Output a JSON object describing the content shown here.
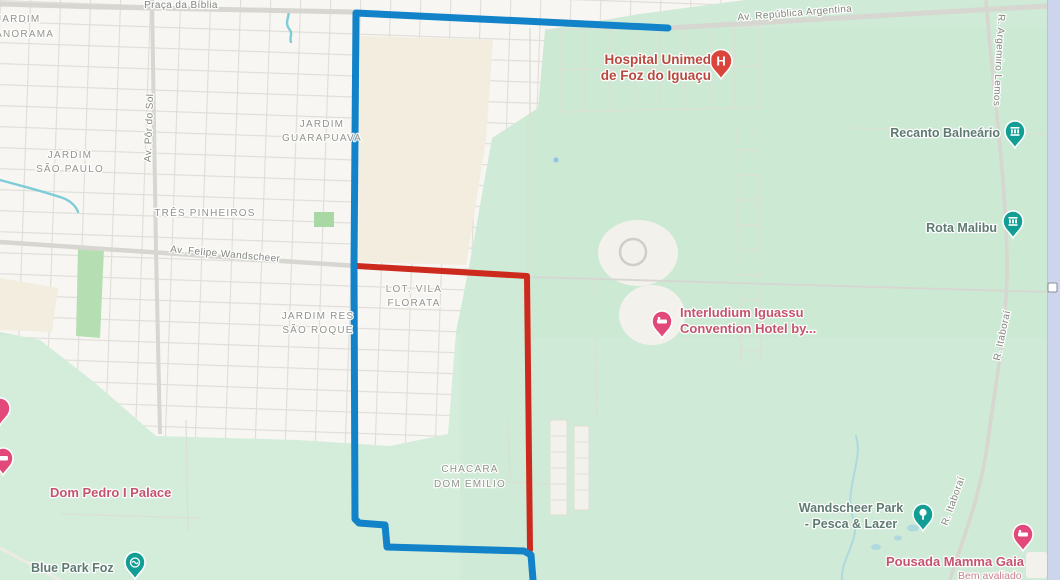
{
  "map": {
    "streets": {
      "praca_da_biblia": "Praça da Bíblia",
      "av_republica_argentina": "Av. República Argentina",
      "r_argemiro_lemos": "R. Argemiro Lemos",
      "av_por_do_sol": "Av. Pôr do Sol",
      "av_felipe_wandscheer": "Av. Felipe Wandscheer",
      "r_itaborai_upper": "R. Itaboraí",
      "r_itaborai_lower": "R. Itaboraí"
    },
    "areas": {
      "jardim_panorama_l1": "JARDIM",
      "jardim_panorama_l2": "PANORAMA",
      "jardim_guarapuava_l1": "JARDIM",
      "jardim_guarapuava_l2": "GUARAPUAVA",
      "jardim_sao_paulo_l1": "JARDIM",
      "jardim_sao_paulo_l2": "SÃO PAULO",
      "tres_pinheiros": "TRÊS PINHEIROS",
      "lot_vila_florata_l1": "LOT. VILA",
      "lot_vila_florata_l2": "FLORATA",
      "jardim_res_sao_roque_l1": "JARDIM RES",
      "jardim_res_sao_roque_l2": "SÃO ROQUE",
      "chacara_dom_emilio_l1": "CHACARA",
      "chacara_dom_emilio_l2": "DOM EMILIO"
    },
    "pois": {
      "hospital_l1": "Hospital Unimed",
      "hospital_l2": "de Foz do Iguaçu",
      "hospital_glyph": "H",
      "recanto_balneario": "Recanto Balneário",
      "rota_malibu": "Rota Malibu",
      "interludium_l1": "Interludium Iguassu",
      "interludium_l2": "Convention Hotel by...",
      "dom_pedro": "Dom Pedro I Palace",
      "blue_park": "Blue Park Foz",
      "wandscheer_l1": "Wandscheer Park",
      "wandscheer_l2": "- Pesca & Lazer",
      "mamma_gaia": "Pousada Mamma Gaia",
      "mamma_gaia_sub": "Bem avaliado"
    },
    "routes": {
      "blue_path": "M668,28 L356,13 L354,266 L355,519 L359,523 L385,525 L387,547 L524,551 L531,555 L533,580",
      "red_path": "M357,266 L527,276 L530,550",
      "blue_color": "#1283c9",
      "red_color": "#cd2a1e"
    },
    "colors": {
      "map_green": "#cfead6",
      "urban_white": "#f7f6f2",
      "beige": "#f2edde",
      "park_green": "#b6deb3",
      "pin_teal": "#129e94",
      "pin_rose": "#e2497a",
      "pin_hospital_red": "#d9453c",
      "label_red": "#b9493f",
      "label_rose": "#c6536e",
      "label_teal": "#5f7a72",
      "scroll_strip": "#cdd5ec"
    }
  }
}
